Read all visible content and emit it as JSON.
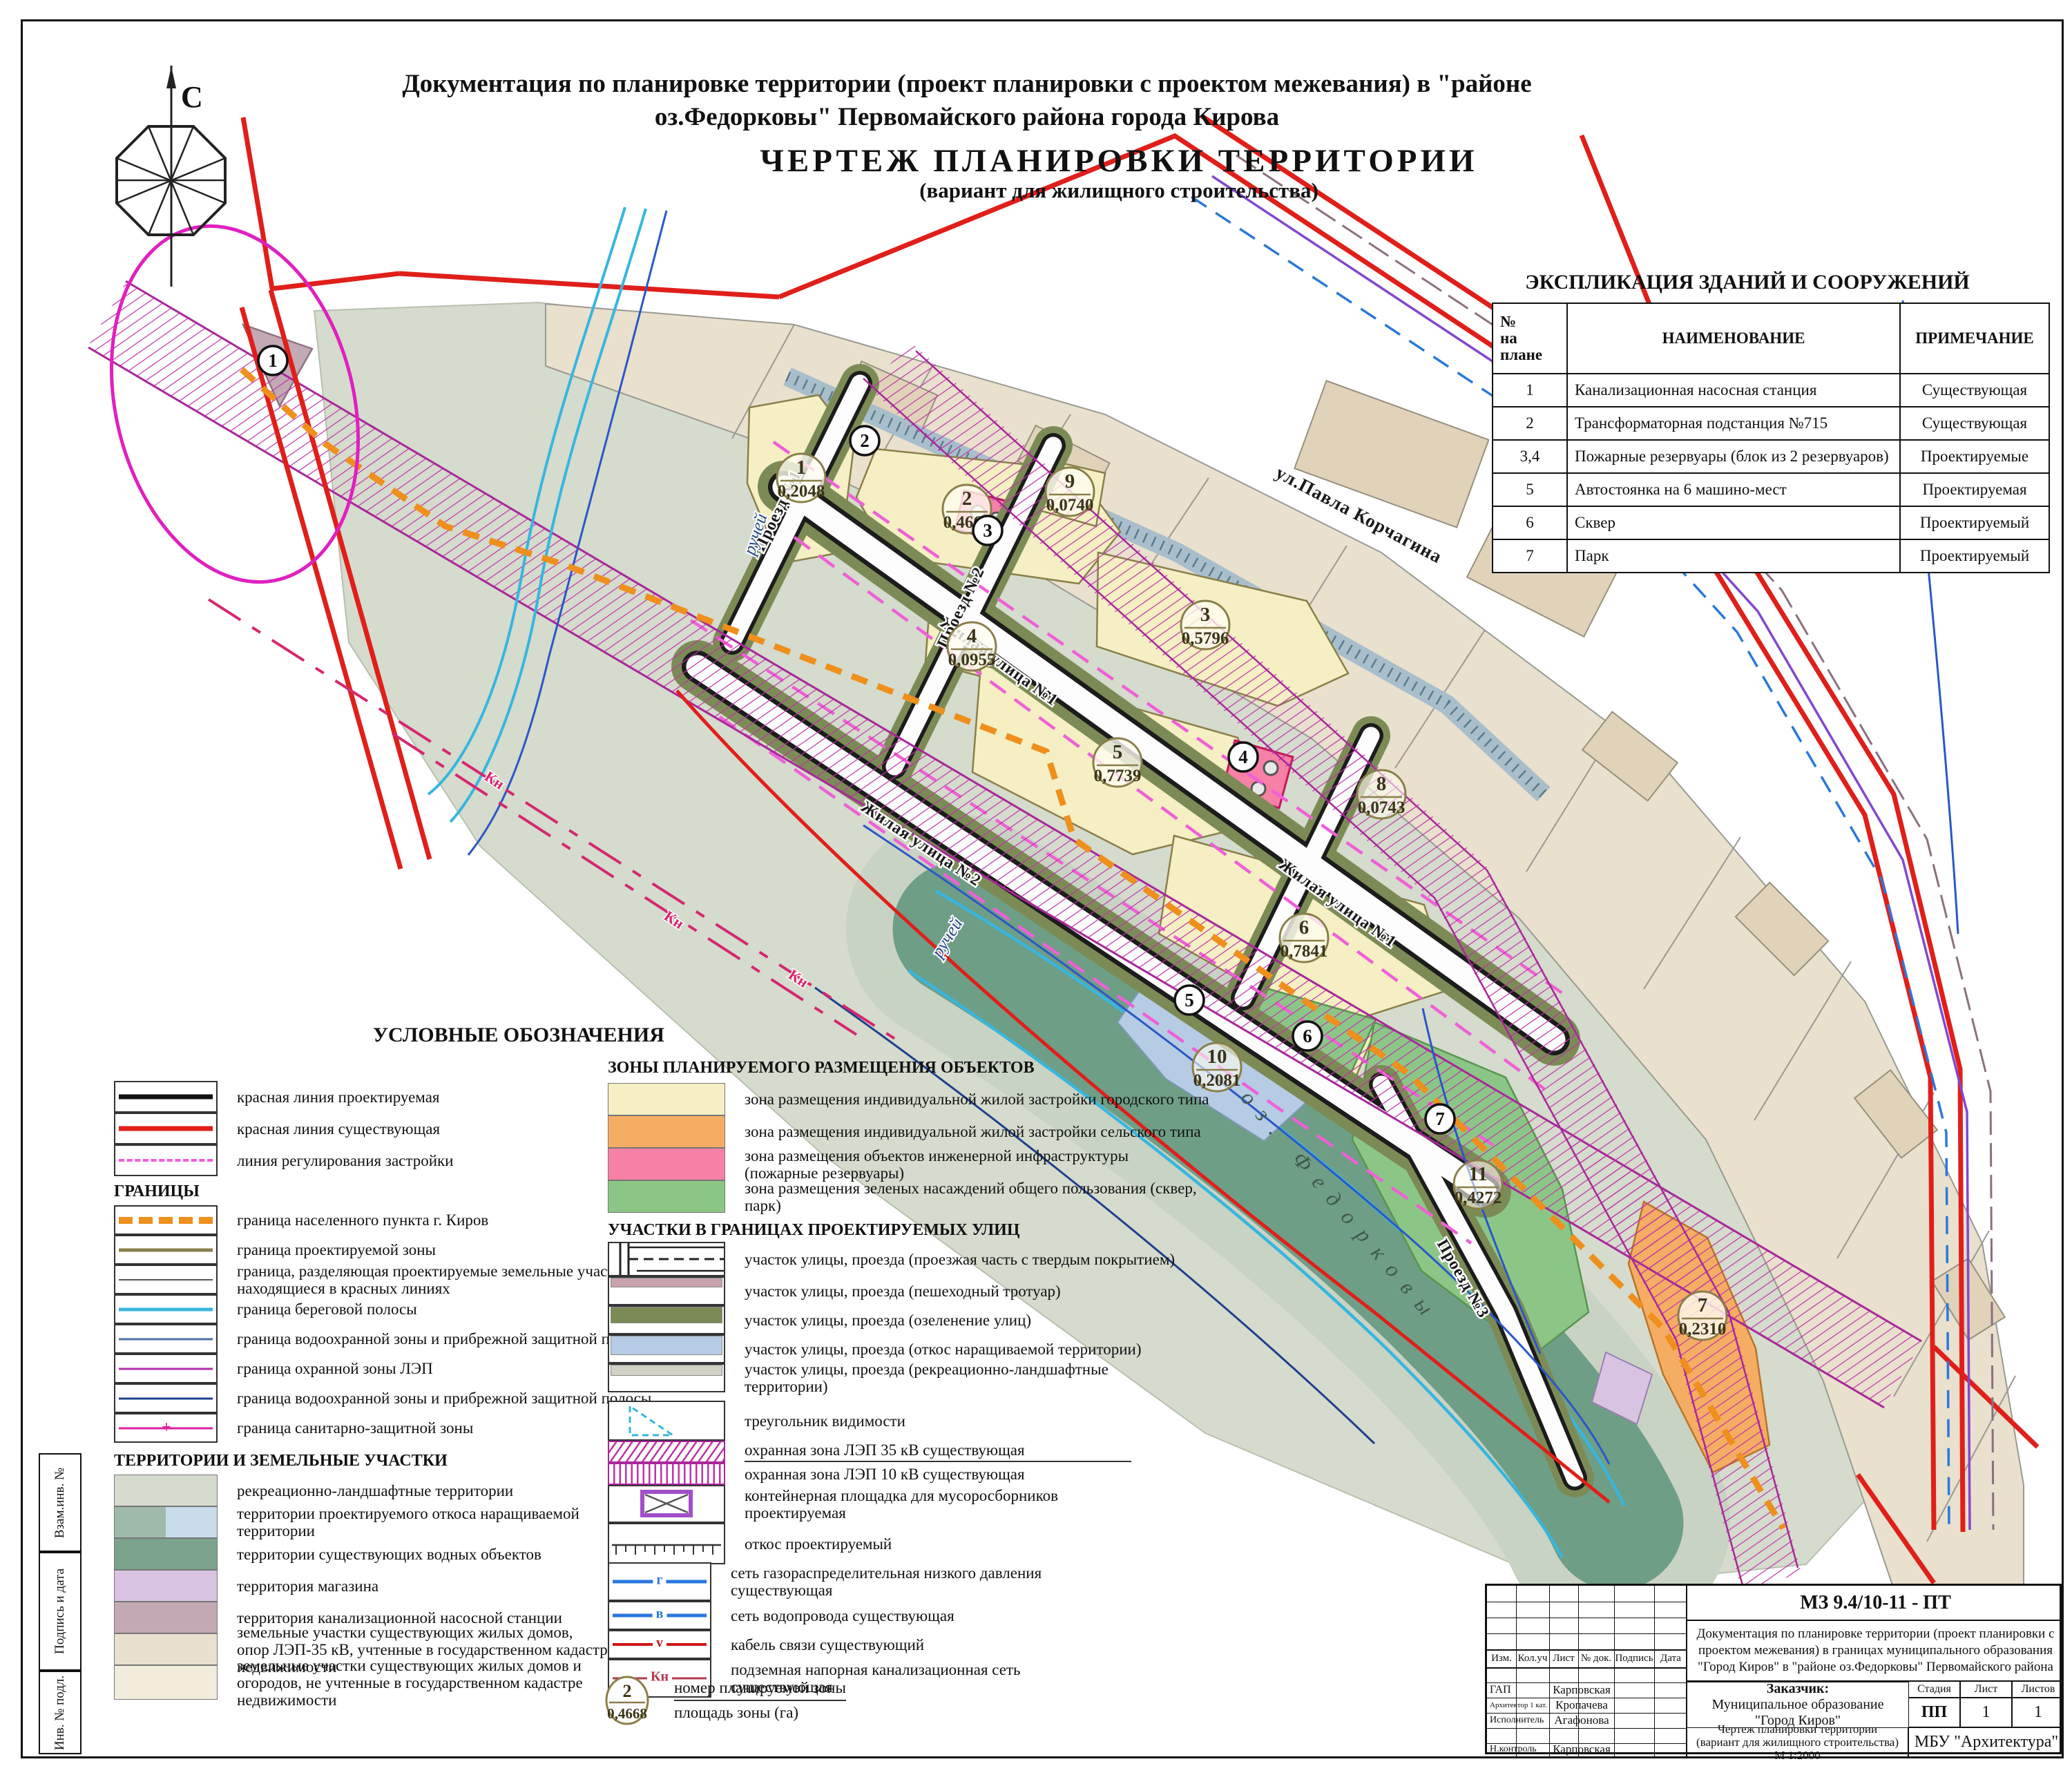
{
  "sheet": {
    "north_label": "С"
  },
  "title": {
    "line1": "Документация по планировке территории (проект планировки с проектом межевания)  в \"районе",
    "line2": "оз.Федорковы\" Первомайского  района города Кирова",
    "line3": "ЧЕРТЕЖ  ПЛАНИРОВКИ  ТЕРРИТОРИИ",
    "line4": "(вариант для жилищного строительства)"
  },
  "explication": {
    "title": "ЭКСПЛИКАЦИЯ ЗДАНИЙ И СООРУЖЕНИЙ",
    "col_num": "№\nна\nплане",
    "col_name": "НАИМЕНОВАНИЕ",
    "col_note": "ПРИМЕЧАНИЕ",
    "rows": [
      {
        "n": "1",
        "name": "Канализационная насосная станция",
        "note": "Существующая"
      },
      {
        "n": "2",
        "name": "Трансформаторная подстанция  №715",
        "note": "Существующая"
      },
      {
        "n": "3,4",
        "name": "Пожарные резервуары (блок из 2 резервуаров)",
        "note": "Проектируемые"
      },
      {
        "n": "5",
        "name": "Автостоянка на 6 машино-мест",
        "note": "Проектируемая"
      },
      {
        "n": "6",
        "name": "Сквер",
        "note": "Проектируемый"
      },
      {
        "n": "7",
        "name": "Парк",
        "note": "Проектируемый"
      }
    ]
  },
  "legend": {
    "title": "УСЛОВНЫЕ ОБОЗНАЧЕНИЯ",
    "lines": [
      "красная линия проектируемая",
      "красная линия существующая",
      "линия регулирования застройки"
    ],
    "borders_title": "ГРАНИЦЫ",
    "borders": [
      "граница населенного пункта г. Киров",
      "граница проектируемой зоны",
      "граница, разделяющая проектируемые земельные участки,\nнаходящиеся в красных линиях",
      "граница береговой полосы",
      "граница водоохранной зоны и прибрежной защитной полосы",
      "граница охранной зоны ЛЭП",
      "граница водоохранной зоны и прибрежной защитной полосы",
      "граница санитарно-защитной зоны"
    ],
    "territories_title": "ТЕРРИТОРИИ И ЗЕМЕЛЬНЫЕ УЧАСТКИ",
    "territories": [
      "рекреационно-ландшафтные территории",
      "территории проектируемого откоса наращиваемой\nтерритории",
      "территории существующих водных объектов",
      "территория магазина",
      "территория канализационной насосной станции",
      "земельные участки существующих жилых домов,\nопор ЛЭП-35 кВ, учтенные в государственном кадастре недвижимости",
      "земельные участки существующих жилых домов и\nогородов, не учтенные в государственном кадастре\nнедвижимости"
    ],
    "zones_title": "ЗОНЫ ПЛАНИРУЕМОГО РАЗМЕЩЕНИЯ ОБЪЕКТОВ",
    "zones": [
      "зона размещения индивидуальной жилой застройки городского типа",
      "зона размещения индивидуальной жилой застройки сельского типа",
      "зона размещения объектов инженерной инфраструктуры\n(пожарные резервуары)",
      "зона размещения зеленых насаждений общего пользования (сквер, парк)"
    ],
    "streets_title": "УЧАСТКИ В ГРАНИЦАХ ПРОЕКТИРУЕМЫХ УЛИЦ",
    "streets": [
      "участок улицы, проезда  (проезжая часть с твердым покрытием)",
      "участок улицы, проезда (пешеходный тротуар)",
      "участок улицы, проезда (озеленение улиц)",
      "участок улицы, проезда (откос наращиваемой территории)",
      "участок улицы, проезда (рекреационно-ландшафтные\nтерритории)"
    ],
    "symbols": [
      "треугольник видимости",
      "охранная зона ЛЭП 35 кВ существующая",
      "охранная зона ЛЭП 10 кВ существующая",
      "контейнерная площадка для мусоросборников\nпроектируемая",
      "откос проектируемый"
    ],
    "networks": [
      {
        "mark": "г",
        "label": "сеть газораспределительная низкого давления\nсуществующая"
      },
      {
        "mark": "в",
        "label": "сеть водопровода существующая"
      },
      {
        "mark": "v",
        "label": "кабель связи существующий"
      },
      {
        "mark": "Кн",
        "label": "подземная напорная канализационная сеть\nсуществующая"
      }
    ],
    "zone_number": {
      "num": "2",
      "area": "0,4668",
      "line1": "номер планируемой зоны",
      "line2": "площадь зоны  (га)"
    }
  },
  "map": {
    "streets": {
      "korchagina": "ул.Павла Корчагина",
      "zhilaya1": "Жилая улица №1",
      "zhilaya2": "Жилая улица №2",
      "proezd1": "Проезд №1",
      "proezd2": "Проезд №2",
      "proezd3": "Проезд №3"
    },
    "water": {
      "lake": "оз. Федорковы",
      "stream": "ручей"
    },
    "net_label_kn": "Кн",
    "zones": [
      {
        "num": "1",
        "area": "0,2048"
      },
      {
        "num": "2",
        "area": "0,4668"
      },
      {
        "num": "9",
        "area": "0,0740"
      },
      {
        "num": "3",
        "area": "0,5796"
      },
      {
        "num": "4",
        "area": "0,0955"
      },
      {
        "num": "5",
        "area": "0,7739"
      },
      {
        "num": "6",
        "area": "0,7841"
      },
      {
        "num": "8",
        "area": "0,0743"
      },
      {
        "num": "10",
        "area": "0,2081"
      },
      {
        "num": "11",
        "area": "0,4272"
      },
      {
        "num": "7",
        "area": "0,2310"
      }
    ],
    "objects": [
      "1",
      "2",
      "3",
      "4",
      "5",
      "6",
      "7"
    ]
  },
  "titleblock": {
    "doc_code": "МЗ 9.4/10-11 - ПТ",
    "doc_desc": "Документация по планировке территории (проект планировки с\nпроектом межевания) в границах муниципального образования\n\"Город Киров\" в \"районе оз.Федорковы\" Первомайского района",
    "cols": [
      "Изм.",
      "Кол.уч",
      "Лист",
      "№ док.",
      "Подпись",
      "Дата"
    ],
    "roles": [
      {
        "role": "ГАП",
        "name": "Карповская"
      },
      {
        "role": "Архитектор 1 кат.",
        "name": "Кропачева"
      },
      {
        "role": "Исполнитель",
        "name": "Агафонова"
      },
      {
        "role": "Н.контроль",
        "name": "Карповская"
      }
    ],
    "customer_label": "Заказчик:",
    "customer": "Муниципальное образование\n\"Город Киров\"",
    "stage_label": "Стадия",
    "sheet_label": "Лист",
    "sheets_label": "Листов",
    "stage": "ПП",
    "sheet_num": "1",
    "sheets_total": "1",
    "drawing_title": "Чертеж планировки территории\n(вариант для жилищного строительства)\nМ 1:2000",
    "org": "МБУ \"Архитектура\""
  },
  "side_stamp": {
    "c1": "Взам.инв. №",
    "c2": "Подпись и дата",
    "c3": "Инв. № подл."
  },
  "colors": {
    "red_line_existing": "#e01f1a",
    "red_line_planned": "#111111",
    "regulation_line": "#f05fd8",
    "city_boundary": "#ef8f1c",
    "planned_zone_boundary": "#8a7f4a",
    "coastal_strip": "#37b6df",
    "water_guard_zone": "#4a6fa5",
    "lep_guard_zone": "#b52ea8",
    "sanitary_zone": "#e0219f",
    "recreation": "#d5dbcd",
    "slope_territory": "#9fb9ab",
    "slope_territory2": "#c8dcec",
    "water_objects": "#6f9e86",
    "shop_territory": "#d8c4e2",
    "kns_territory": "#c3a9b4",
    "plots_cadastre": "#e9e0cd",
    "plots_noncadastre": "#f1ecdc",
    "zone_urban_housing": "#f5efc3",
    "zone_rural_housing": "#f5ad63",
    "zone_infrastructure": "#f780a6",
    "zone_green": "#8cc687",
    "street_sidewalk": "#c8a2aa",
    "street_greenery": "#7c8b56",
    "street_slope": "#b6cce4",
    "street_recreation": "#d0d0c4",
    "gas_net": "#2a78dd",
    "water_net": "#2a78dd",
    "cable_net": "#d01616",
    "sewer_net": "#b5384f"
  }
}
